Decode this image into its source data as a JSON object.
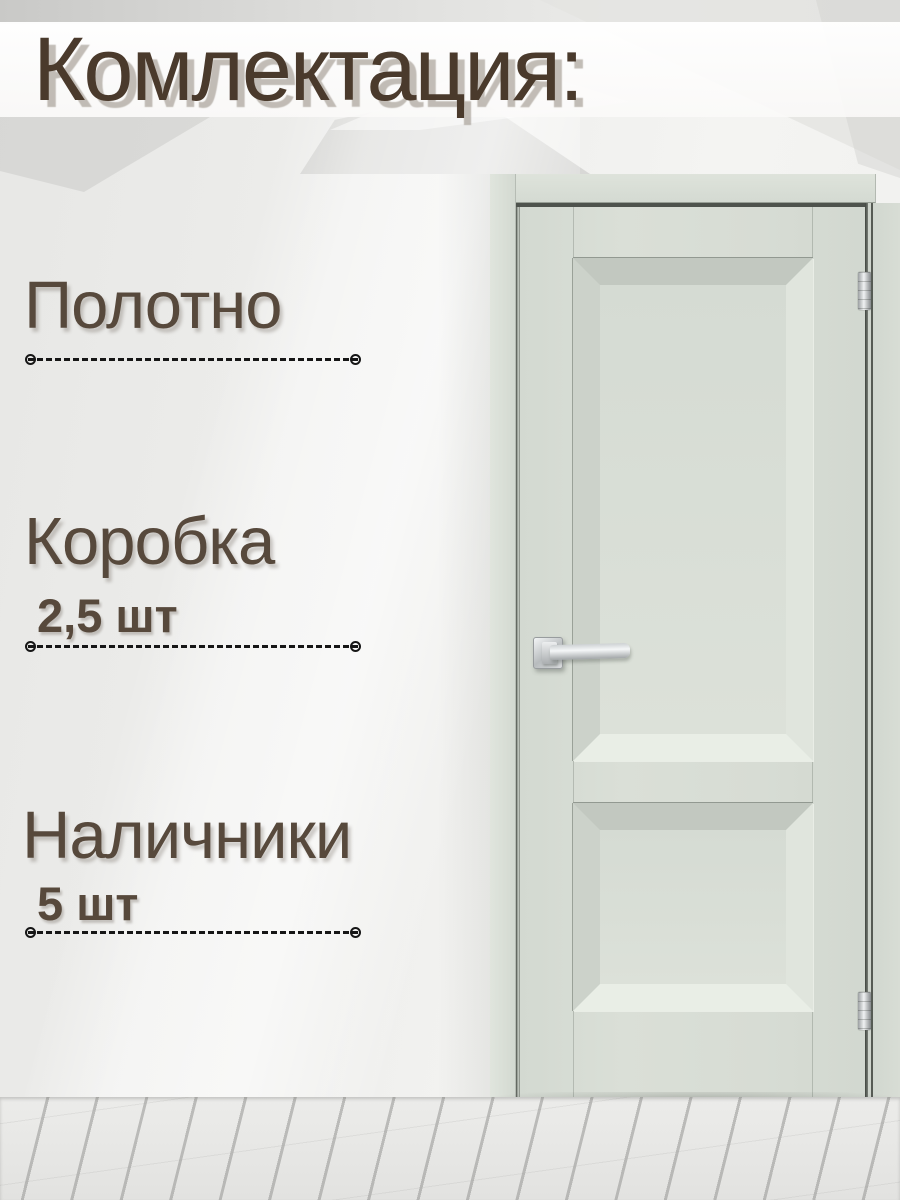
{
  "header": {
    "title": "Комлектация:"
  },
  "items": [
    {
      "name": "Полотно",
      "qty": ""
    },
    {
      "name": "Коробка",
      "qty": "2,5 шт"
    },
    {
      "name": "Наличники",
      "qty": "5 шт"
    }
  ],
  "door": {
    "description": "light sage-grey interior door with two raised panels, chrome lever handle on left stile, two chrome hinges on right edge, frame and casing"
  },
  "colors": {
    "accent_text": "#4a3a2c",
    "item_text": "#57493c",
    "separator": "#161616",
    "door_sage": "#d6dbd3",
    "wall": "#efefed",
    "floor": "#ececea"
  }
}
